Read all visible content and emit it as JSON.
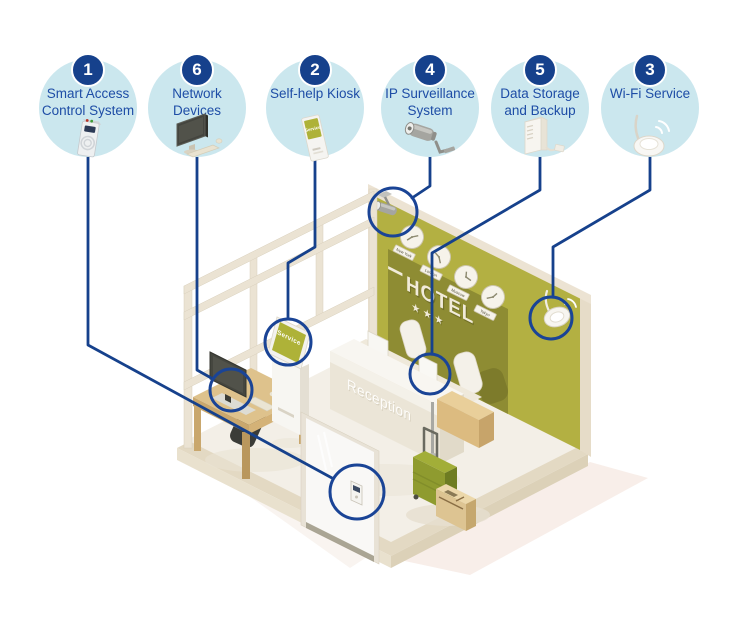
{
  "callouts": [
    {
      "number": "1",
      "line1": "Smart Access",
      "line2": "Control System",
      "icon": "card-reader"
    },
    {
      "number": "6",
      "line1": "Network",
      "line2": "Devices",
      "icon": "desktop-computer"
    },
    {
      "number": "2",
      "line1": "Self-help Kiosk",
      "line2": "",
      "icon": "kiosk"
    },
    {
      "number": "4",
      "line1": "IP Surveillance",
      "line2": "System",
      "icon": "cctv-camera"
    },
    {
      "number": "5",
      "line1": "Data Storage",
      "line2": "and Backup",
      "icon": "storage-server"
    },
    {
      "number": "3",
      "line1": "Wi-Fi Service",
      "line2": "",
      "icon": "wifi-router"
    }
  ],
  "room": {
    "hotel_sign": "HOTEL",
    "hotel_stars": "★★★",
    "reception_label": "Reception",
    "kiosk_screen_label": "Service",
    "clocks": [
      {
        "city": "New York"
      },
      {
        "city": "London"
      },
      {
        "city": "Moscow"
      },
      {
        "city": "Tokyo"
      }
    ]
  },
  "colors": {
    "accent_navy": "#16418c",
    "label_blue": "#1e4da6",
    "callout_fill": "#cbe7ee",
    "highlight_ring": "#1a4496",
    "wall_olive": "#b3b042",
    "panel_olive_dark": "#8e8c33",
    "trim_cream": "#ece3d3",
    "floor_cream": "#f3efe7",
    "wood_tan": "#d9bc85"
  }
}
